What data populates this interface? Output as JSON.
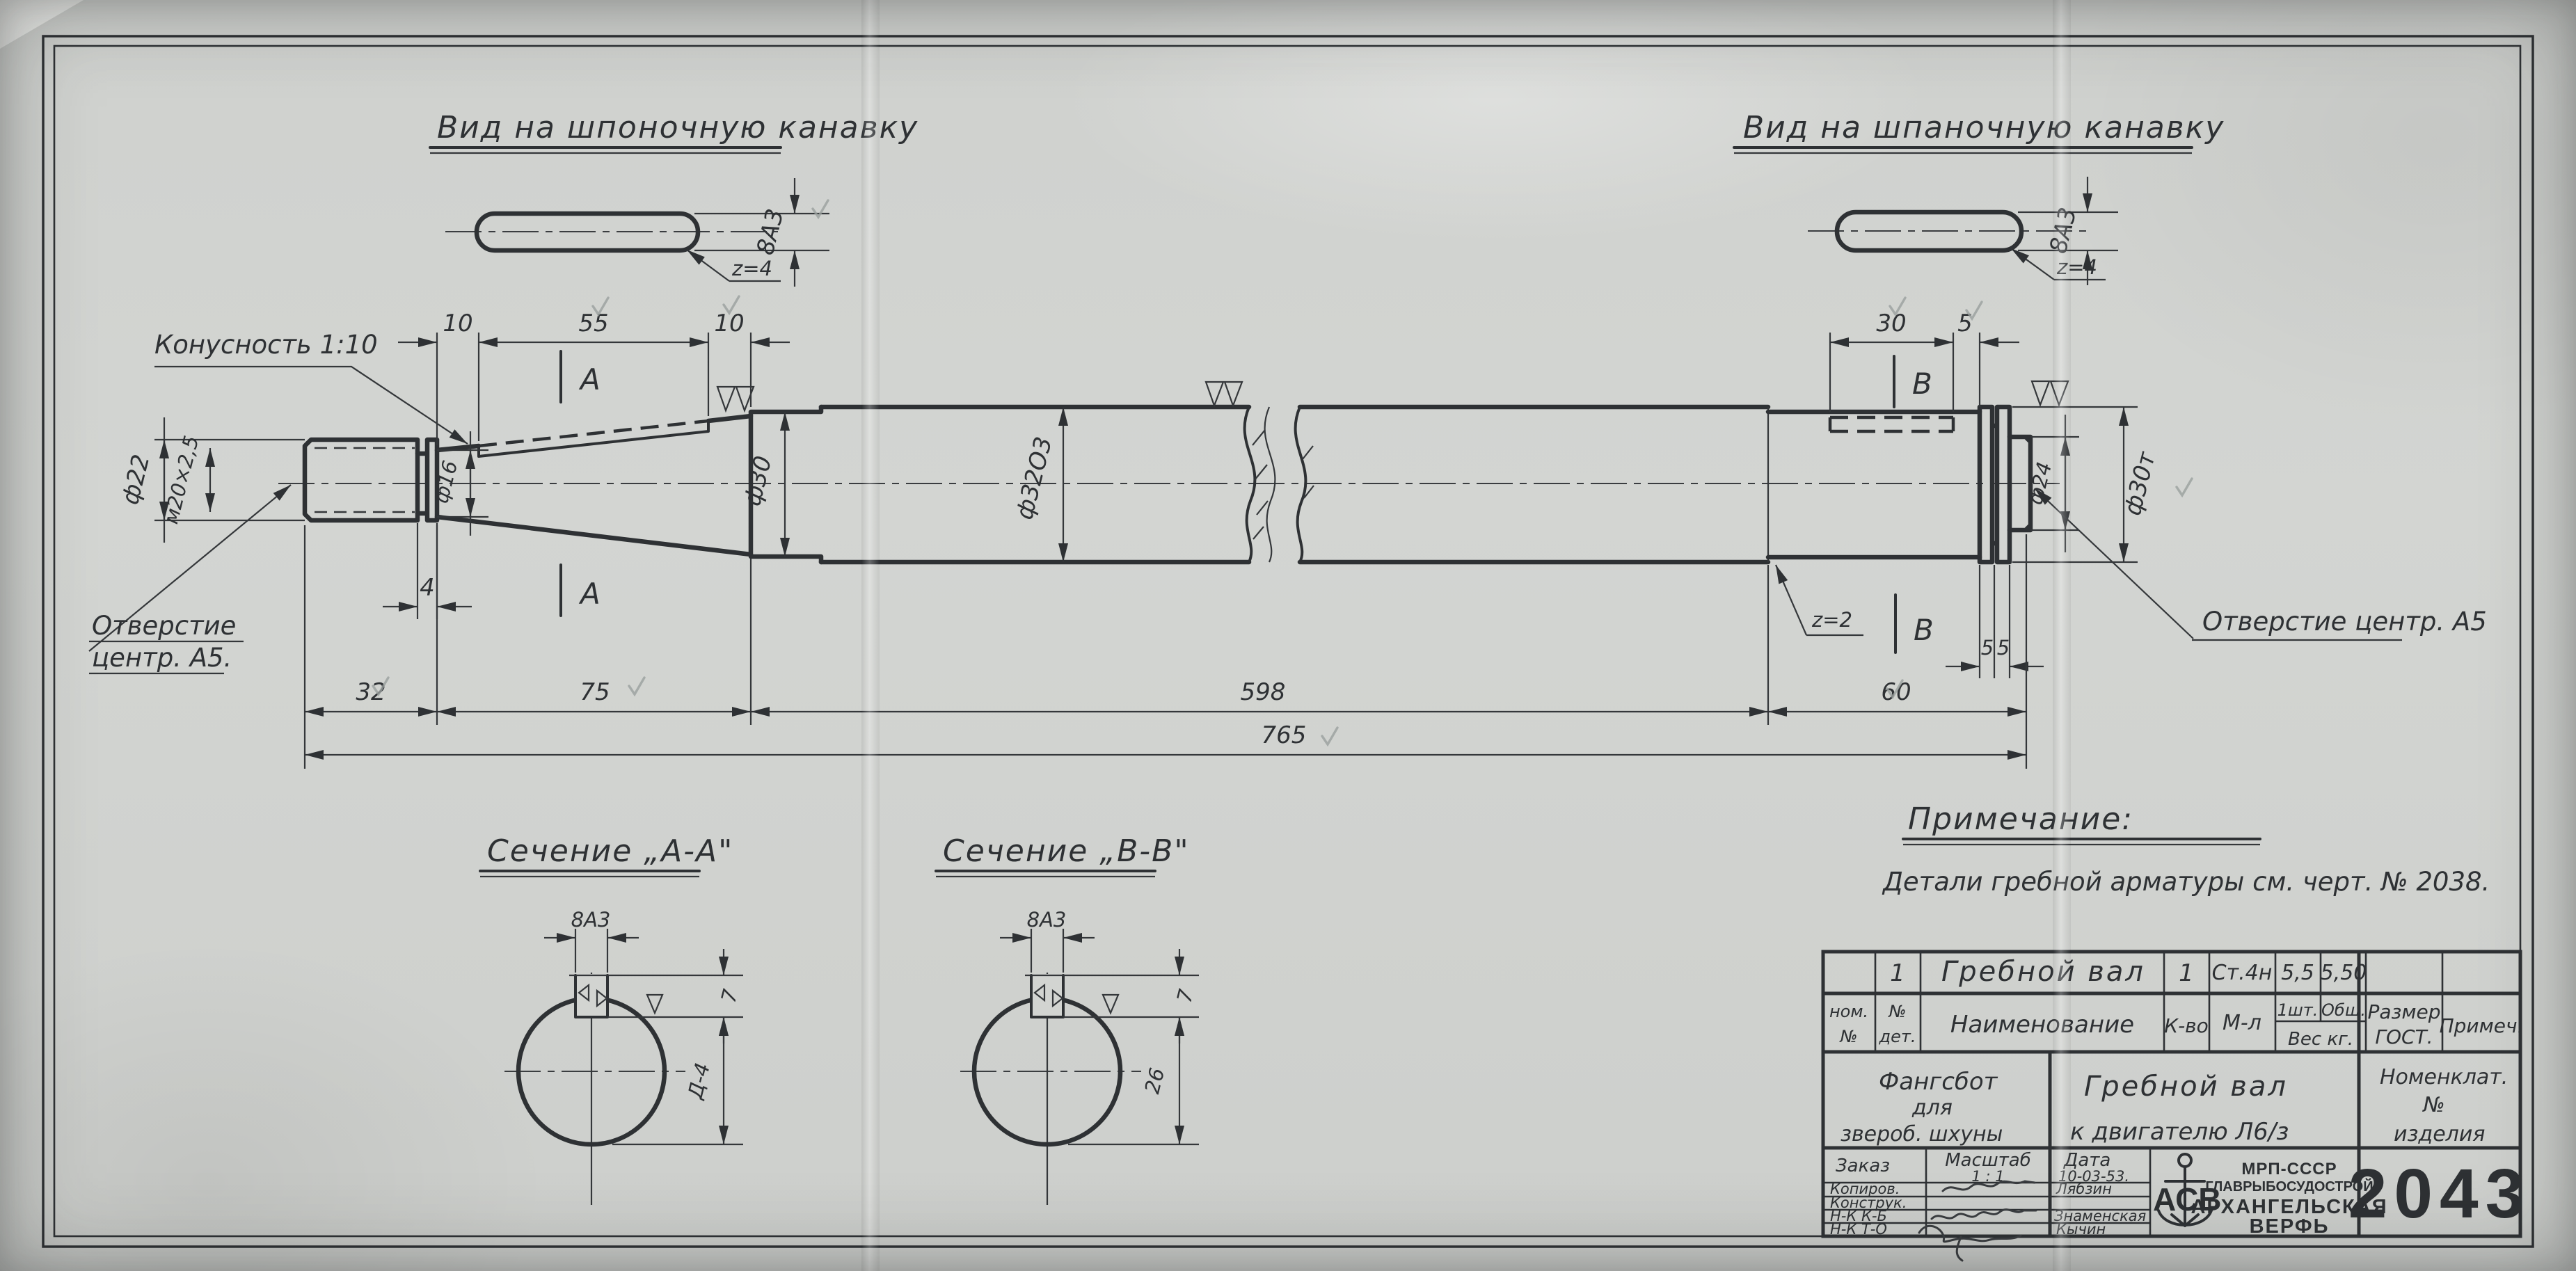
{
  "views": {
    "left_keyway": {
      "title": "Вид на шпоночную канавку",
      "width_dim": "8А3",
      "teeth": "z=4"
    },
    "right_keyway": {
      "title": "Вид на шпаночную канавку",
      "width_dim": "8А3",
      "teeth": "z=4"
    }
  },
  "shaft": {
    "taper_label": "Конусность 1:10",
    "hole_left_line1": "Отверстие",
    "hole_left_line2": "центр. А5.",
    "hole_right": "Отверстие центр. А5",
    "z2": "z=2",
    "section_a": "А",
    "section_b": "В",
    "dims": {
      "d22": "ф22",
      "m20": "м20×2,5",
      "d16": "ф16",
      "w4": "4",
      "t10a": "10",
      "t55": "55",
      "t10b": "10",
      "d30": "ф30",
      "d32": "ф32О3",
      "k30": "30",
      "k5": "5",
      "r5a": "5",
      "r5b": "5",
      "d24": "ф24",
      "d30t": "ф30т",
      "b32": "32",
      "b75": "75",
      "b598": "598",
      "b60": "60",
      "b765": "765"
    }
  },
  "sections": {
    "aa": {
      "title": "Сечение „А-А\"",
      "width": "8А3",
      "depth": "7",
      "height": "Д-4"
    },
    "bb": {
      "title": "Сечение „В-В\"",
      "width": "8А3",
      "depth": "7",
      "height": "26"
    }
  },
  "note": {
    "title": "Примечание:",
    "body": "Детали  гребной  арматуры  см.  черт.  № 2038."
  },
  "title_block": {
    "row1": {
      "det_no": "1",
      "name": "Гребной вал",
      "qty": "1",
      "material": "Ст.4н",
      "weight_unit": "5,5",
      "weight_total": "5,50"
    },
    "headers": {
      "nom1": "ном.",
      "nom2": "№",
      "det1": "№",
      "det2": "дет.",
      "name": "Наименование",
      "qty": "К-во",
      "mat": "М-л",
      "w1": "1шт.",
      "w2": "Общ.",
      "w3": "Вес кг.",
      "size1": "Размер",
      "size2": "ГОСТ.",
      "note": "Примеч."
    },
    "project": {
      "l1": "Фангсбот",
      "l2": "для",
      "l3": "звероб. шхуны"
    },
    "part": {
      "l1": "Гребной  вал",
      "l2": "к двигателю  Л6/з"
    },
    "nomen": {
      "l1": "Номенклат.",
      "l2": "№",
      "l3": "изделия"
    },
    "order_label": "Заказ",
    "scale_label": "Масштаб",
    "scale_value": "1 : 1",
    "date_label": "Дата",
    "date_value": "10-03-53.",
    "rows": [
      {
        "role": "Копиров.",
        "name": "Лябзин"
      },
      {
        "role": "Конструк.",
        "name": ""
      },
      {
        "role": "Н-К  К-Б",
        "name": "Знаменская"
      },
      {
        "role": "Н-К  Т-О",
        "name": "Кычин"
      }
    ],
    "stamp": {
      "monogram": "АСВ",
      "org1": "МРП-СССР",
      "org2": "ГЛАВРЫБОСУДОСТРОЙ",
      "org3": "АРХАНГЕЛЬСКАЯ",
      "org4": "ВЕРФЬ",
      "number": "2043"
    }
  }
}
